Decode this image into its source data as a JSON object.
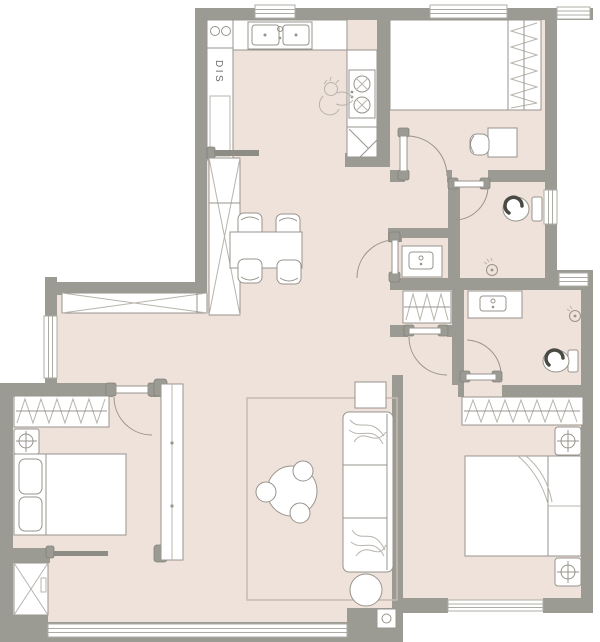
{
  "colors": {
    "floor": "#EEE2DA",
    "wall": "#9B9B93",
    "line": "#98948C",
    "linelight": "#B8B4AC",
    "winline": "#ACACA4",
    "rug": "#C7BAB0",
    "dark": "#4A4A45"
  },
  "plan": {
    "dishwasher_label": "DIS",
    "rooms": [
      {
        "name": "kitchen",
        "fixtures": [
          "double-basin-sink",
          "dishwasher-cabinet",
          "two-burner-cooktop",
          "chef-figure",
          "corner-unit",
          "sliding-door",
          "window"
        ]
      },
      {
        "name": "dining-area",
        "fixtures": [
          "dining-table",
          "four-chairs",
          "tall-pantry-cabinet",
          "long-sideboard-cabinet"
        ]
      },
      {
        "name": "bedroom-top-right",
        "fixtures": [
          "platform-bed",
          "wardrobe",
          "desk",
          "desk-chair",
          "swing-door",
          "window"
        ]
      },
      {
        "name": "bathroom",
        "fixtures": [
          "toilet",
          "floor-drain",
          "swing-door",
          "window"
        ]
      },
      {
        "name": "vanity-nook",
        "fixtures": [
          "vanity-basin",
          "swing-door"
        ]
      },
      {
        "name": "master-suite",
        "fixtures": [
          "closet-nook",
          "ensuite-vanity",
          "ensuite-toilet",
          "floor-drain",
          "wardrobe",
          "double-bed",
          "nightstand-lamp",
          "nightstand-lamp",
          "swing-door",
          "swing-door",
          "window"
        ]
      },
      {
        "name": "bedroom-bottom-left",
        "fixtures": [
          "wardrobe",
          "nightstand-lamp",
          "double-bed",
          "pillows",
          "pivot-panel",
          "sliding-door",
          "storage-box",
          "swing-door"
        ]
      },
      {
        "name": "living-room",
        "fixtures": [
          "rug",
          "sofa",
          "side-table",
          "round-coffee-table",
          "three-stools",
          "pouf",
          "floor-outlet",
          "panorama-window"
        ]
      }
    ]
  }
}
